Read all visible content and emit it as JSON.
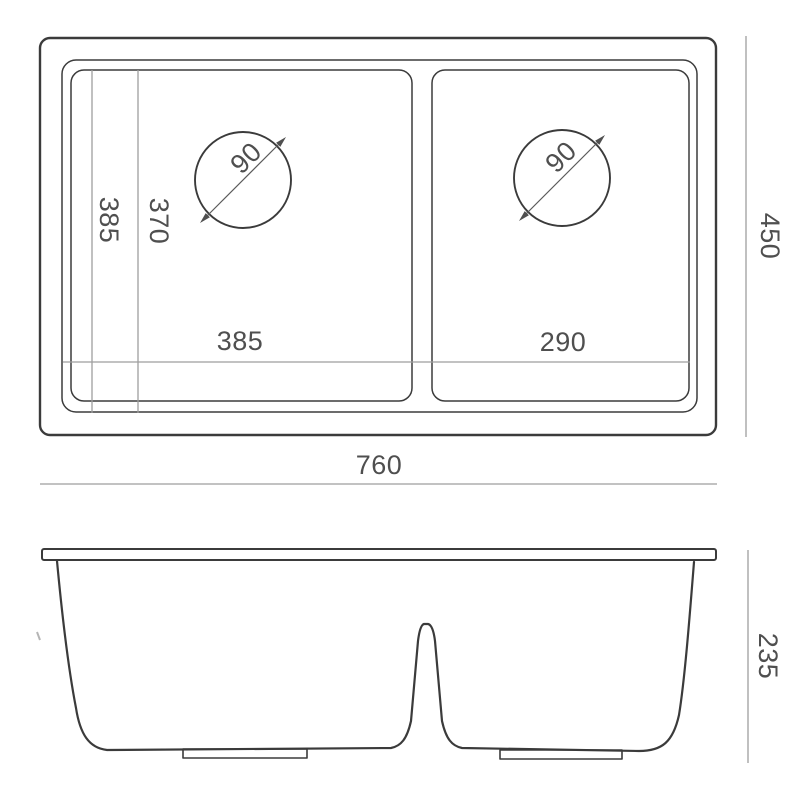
{
  "drawing_type": "sink-dimension-drawing",
  "colors": {
    "background": "#ffffff",
    "outline": "#3b3b3b",
    "dimension_line": "#9e9e9e",
    "label_text": "#4f4f4f"
  },
  "top_view": {
    "left_bowl_width_label": "385",
    "right_bowl_width_label": "290",
    "bowl_depth_label": "385",
    "bowl_inner_depth_label": "370",
    "left_drain_diameter_label": "90",
    "right_drain_diameter_label": "90",
    "overall_width_label": "760",
    "overall_depth_label": "450"
  },
  "front_view": {
    "overall_height_label": "235"
  }
}
